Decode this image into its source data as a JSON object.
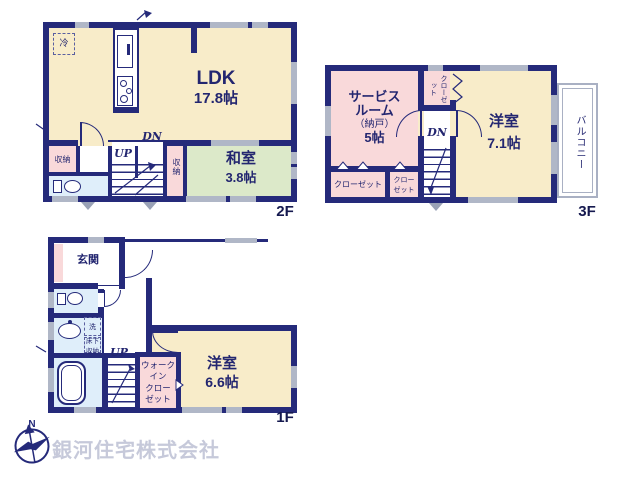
{
  "colors": {
    "wall_navy": "#252a7a",
    "room_cream": "#f8ecc9",
    "room_green": "#dce9c9",
    "room_pink": "#f9d9da",
    "room_blue": "#dfeefa",
    "window_gray": "#b0b7c7",
    "watermark_gray": "#c6c9da"
  },
  "floors": {
    "f2": {
      "floor_label": "2F",
      "ldk": {
        "name": "LDK",
        "size": "17.8帖"
      },
      "washitsu": {
        "name": "和室",
        "size": "3.8帖"
      },
      "storage_left": "収納",
      "storage_strip": "収納",
      "fridge": "冷",
      "up": "UP",
      "dn": "DN"
    },
    "f3": {
      "floor_label": "3F",
      "service_room_lines": [
        "サービス",
        "ルーム",
        "（納戸）",
        "5帖"
      ],
      "closet_top": "クローゼット",
      "yoshitsu": {
        "name": "洋室",
        "size": "7.1帖"
      },
      "closet_a": "クローゼット",
      "closet_b_lines": [
        "クロー",
        "ゼット"
      ],
      "balcony": "バルコニー",
      "dn": "DN"
    },
    "f1": {
      "floor_label": "1F",
      "genkan": "玄関",
      "laundry": "洗",
      "underfloor_lines": [
        "床下",
        "収納"
      ],
      "wic_lines": [
        "ウォーク",
        "イン",
        "クロー",
        "ゼット"
      ],
      "yoshitsu": {
        "name": "洋室",
        "size": "6.6帖"
      },
      "up": "UP"
    }
  },
  "compass": {
    "north_label": "N"
  },
  "company": {
    "name": "銀河住宅株式会社"
  }
}
